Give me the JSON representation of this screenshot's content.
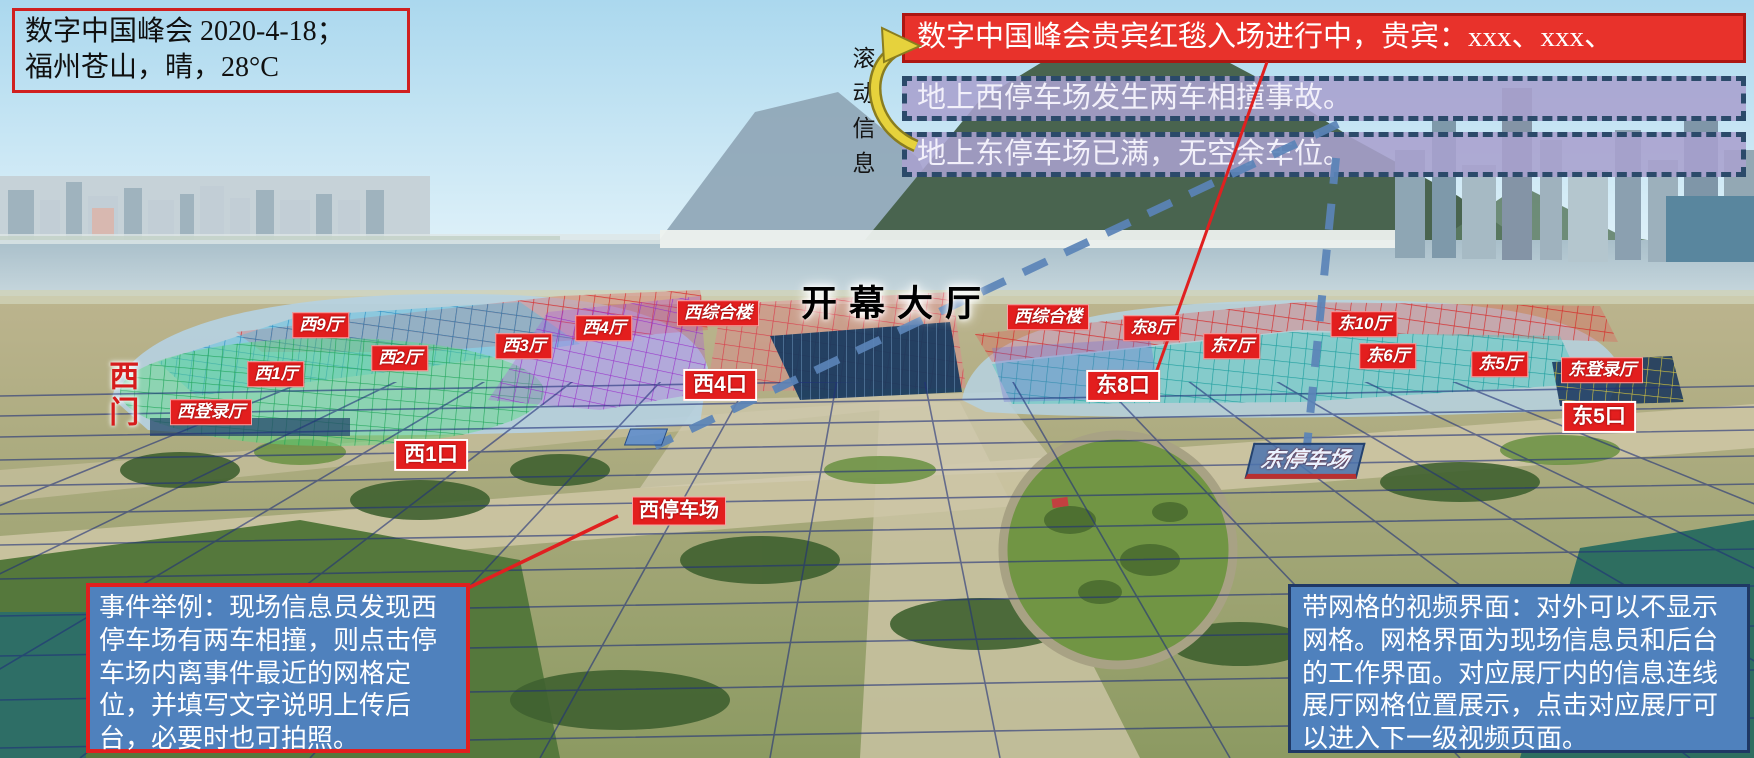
{
  "page": {
    "width": 1754,
    "height": 758
  },
  "colors": {
    "accent_red": "#e01f1f",
    "banner_red_bg": "#e8322b",
    "banner_red_border": "#ad1612",
    "ticker_purple_bg": "#a8a0ce",
    "ticker_dash_border": "#2b4a6a",
    "note_blue_bg": "#4f81bd",
    "note_navy_border": "#1f3864",
    "dashed_connector_blue": "#5b84b8",
    "ground_grid_navy": "#20307a",
    "scroll_arrow_yellow": "#e6d23c"
  },
  "status_box": {
    "line1": "数字中国峰会 2020-4-18；",
    "line2": "福州苍山，晴，28°C"
  },
  "scroll_info": {
    "label": "滚动信息"
  },
  "tickers": [
    {
      "id": "vip-redcarpet",
      "style": "red",
      "text": "数字中国峰会贵宾红毯入场进行中，贵宾：xxx、xxx、"
    },
    {
      "id": "west-parking-accident",
      "style": "purple",
      "text": "地上西停车场发生两车相撞事故。"
    },
    {
      "id": "east-parking-full",
      "style": "purple",
      "text": "地上东停车场已满，无空余车位。"
    }
  ],
  "notes": {
    "event_example": "事件举例：现场信息员发现西停车场有两车相撞，则点击停车场内离事件最近的网格定位，并填写文字说明上传后台，必要时也可拍照。",
    "grid_interface": "带网格的视频界面：对外可以不显示网格。网格界面为现场信息员和后台的工作界面。对应展厅内的信息连线展厅网格位置展示，点击对应展厅可以进入下一级视频页面。"
  },
  "map": {
    "labels": [
      {
        "id": "west-hall-9",
        "text": "西9厅",
        "type": "hall",
        "x": 321,
        "y": 325
      },
      {
        "id": "west-hall-2",
        "text": "西2厅",
        "type": "hall",
        "x": 400,
        "y": 358
      },
      {
        "id": "west-hall-1",
        "text": "西1厅",
        "type": "hall",
        "x": 276,
        "y": 374
      },
      {
        "id": "west-hall-3",
        "text": "西3厅",
        "type": "hall",
        "x": 524,
        "y": 346
      },
      {
        "id": "west-hall-4",
        "text": "西4厅",
        "type": "hall",
        "x": 604,
        "y": 328
      },
      {
        "id": "west-complex",
        "text": "西综合楼",
        "type": "hall",
        "x": 718,
        "y": 313
      },
      {
        "id": "opening-hall",
        "text": "开幕大厅",
        "type": "title",
        "x": 897,
        "y": 303
      },
      {
        "id": "west-complex-2",
        "text": "西综合楼",
        "type": "hall",
        "x": 1048,
        "y": 317
      },
      {
        "id": "east-hall-8",
        "text": "东8厅",
        "type": "hall",
        "x": 1152,
        "y": 328
      },
      {
        "id": "east-hall-7",
        "text": "东7厅",
        "type": "hall",
        "x": 1232,
        "y": 346
      },
      {
        "id": "east-hall-10",
        "text": "东10厅",
        "type": "hall",
        "x": 1364,
        "y": 324
      },
      {
        "id": "east-hall-6",
        "text": "东6厅",
        "type": "hall",
        "x": 1388,
        "y": 356
      },
      {
        "id": "east-hall-5",
        "text": "东5厅",
        "type": "hall",
        "x": 1500,
        "y": 364
      },
      {
        "id": "east-login-hall",
        "text": "东登录厅",
        "type": "hall",
        "x": 1602,
        "y": 370
      },
      {
        "id": "west-login-hall",
        "text": "西登录厅",
        "type": "hall",
        "x": 211,
        "y": 412
      },
      {
        "id": "west-gate",
        "text": "西门",
        "type": "vgate",
        "x": 120,
        "y": 396
      },
      {
        "id": "west-gate-4",
        "text": "西4口",
        "type": "gate",
        "x": 720,
        "y": 385
      },
      {
        "id": "east-gate-8",
        "text": "东8口",
        "type": "gate",
        "x": 1123,
        "y": 386
      },
      {
        "id": "west-gate-1",
        "text": "西1口",
        "type": "gate",
        "x": 431,
        "y": 455
      },
      {
        "id": "east-gate-5",
        "text": "东5口",
        "type": "gate",
        "x": 1599,
        "y": 417
      },
      {
        "id": "west-parking",
        "text": "西停车场",
        "type": "parking",
        "x": 679,
        "y": 511
      },
      {
        "id": "east-parking",
        "text": "东停车场",
        "type": "parking-east",
        "x": 1305,
        "y": 461
      }
    ]
  }
}
